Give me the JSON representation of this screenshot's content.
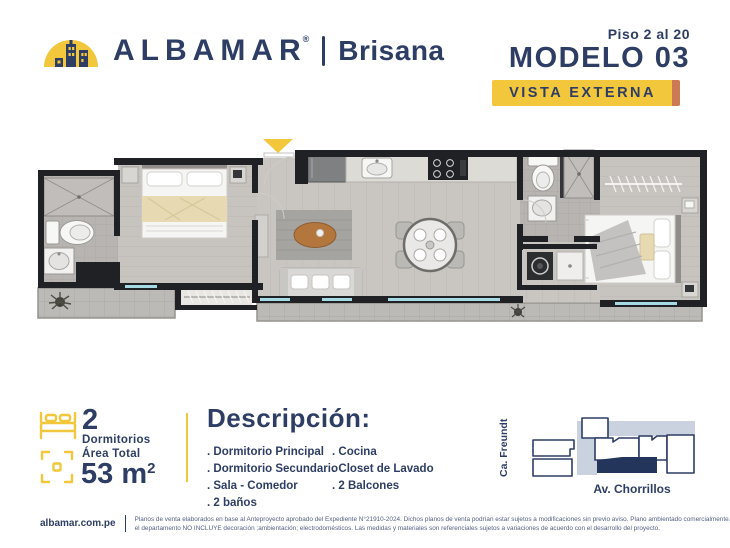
{
  "header": {
    "brand": "ALBAMAR",
    "trademark": "®",
    "project": "Brisana",
    "floors": "Piso 2 al 20",
    "model": "MODELO 03",
    "badge": "VISTA EXTERNA"
  },
  "stats": {
    "bedrooms_value": "2",
    "bedrooms_label": "Dormitorios",
    "area_label": "Área Total",
    "area_value": "53 m",
    "area_sup": "2"
  },
  "description": {
    "title": "Descripción:",
    "column1": [
      ". Dormitorio Principal",
      ". Dormitorio Secundario",
      ". Sala - Comedor",
      ". 2 baños"
    ],
    "column2": [
      ". Cocina",
      ". Closet de Lavado",
      ". 2 Balcones"
    ]
  },
  "map": {
    "street_left": "Ca. Freundt",
    "street_bottom": "Av. Chorrillos"
  },
  "footer": {
    "website": "albamar.com.pe",
    "line1": "Planos de venta elaborados en base al Anteproyecto aprobado del Expediente N°21910-2024. Dichos planos de venta podrían estar sujetos a modificaciones sin previo aviso. Plano ambientado comercialmente.",
    "line2": "el departamento NO INCLUYE decoración ;ambientación; electrodomésticos. Las medidas y materiales son referenciales sujetos a variaciones de acuerdo con el desarrollo del proyecto."
  },
  "colors": {
    "navy": "#2d3d64",
    "yellow": "#f2c73b",
    "badge_accent": "#cb7a55",
    "map_area_fill": "#c9d2de",
    "map_highlight": "#24355c",
    "window_glass": "#a5d9e4"
  }
}
